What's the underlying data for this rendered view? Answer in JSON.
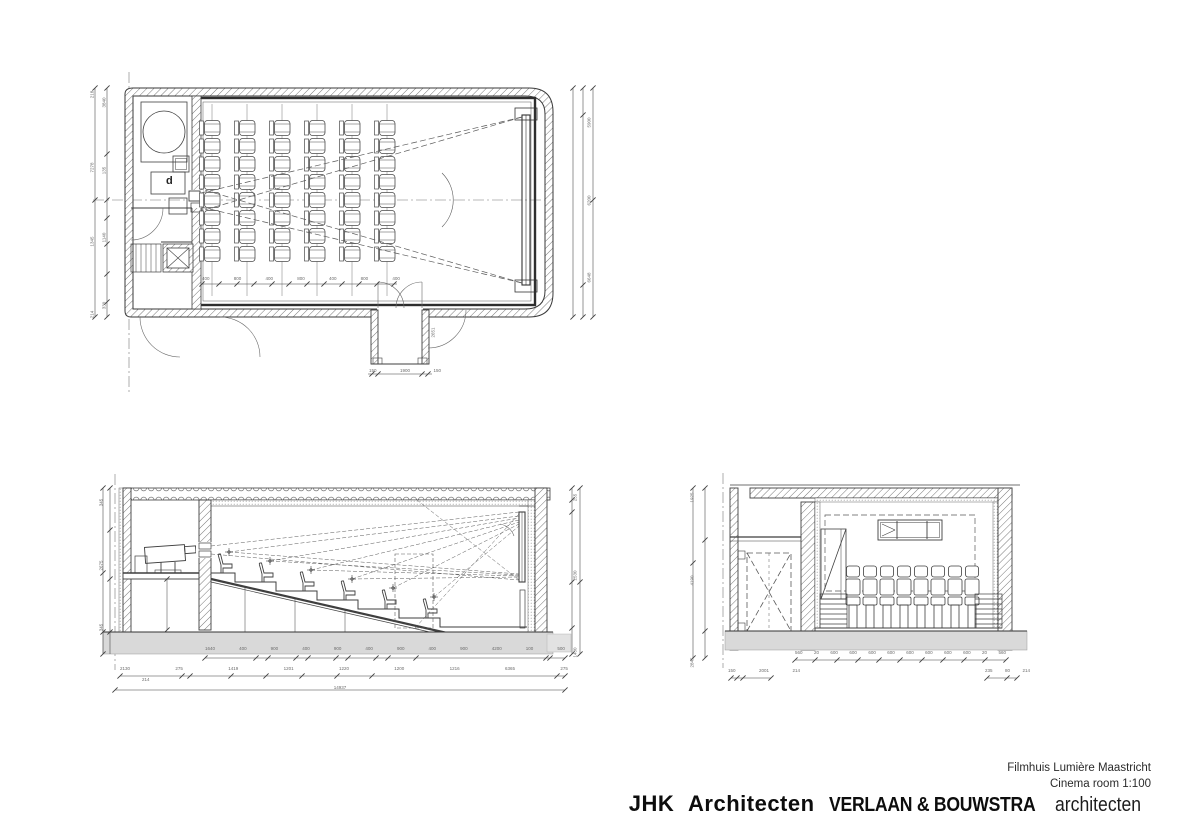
{
  "title_block": {
    "project": "Filmhuis Lumière Maastricht",
    "drawing_title": "Cinema room 1:100",
    "firm_primary": "JHK Architecten",
    "firm_secondary": "VERLAAN & BOUWSTRA",
    "firm_secondary_suffix": "architecten"
  },
  "colors": {
    "line": "#3f3f3f",
    "line_light": "#6b6b6b",
    "slab": "#d9d9d9",
    "text": "#1a1a1a"
  },
  "plan": {
    "name": "Cinema room floor plan",
    "room_label_d": "d",
    "seat_grid": {
      "columns": 6,
      "seats_per_column": 8
    },
    "dims": {
      "entry_bottom": [
        "150",
        "1900",
        "150"
      ],
      "entry_side": "2651",
      "seat_pitch": [
        "400",
        "800",
        "400",
        "800",
        "400",
        "800",
        "400"
      ],
      "left_outer": [
        "218",
        "7278",
        "1345",
        "214"
      ],
      "left_inner": [
        "3840",
        "135",
        "1140",
        "330"
      ],
      "right": [
        "5900",
        "6200",
        "6648"
      ]
    }
  },
  "section_long": {
    "name": "Longitudinal section",
    "seats_in_profile": 6,
    "dims": {
      "row1": [
        "1640",
        "400",
        "900",
        "400",
        "900",
        "400",
        "900",
        "400",
        "900",
        "4200",
        "100",
        "500"
      ],
      "row2": [
        "2130",
        "275",
        "1419",
        "1201",
        "1220",
        "1200",
        "1216",
        "6365",
        "275"
      ],
      "row2_sub": "214",
      "total": "14937",
      "left": [
        "345",
        "2675",
        "345"
      ],
      "right": [
        "255",
        "2530",
        "1430"
      ]
    }
  },
  "section_cross": {
    "name": "Cross section",
    "seats_in_row": 8,
    "dims": {
      "row1": [
        "560",
        "20",
        "600",
        "600",
        "600",
        "600",
        "600",
        "600",
        "600",
        "600",
        "20",
        "560"
      ],
      "row2_left": [
        "150",
        "2001",
        "214"
      ],
      "row2_right": [
        "235",
        "80",
        "214"
      ],
      "left": [
        "1925",
        "4190",
        "2845"
      ]
    }
  }
}
